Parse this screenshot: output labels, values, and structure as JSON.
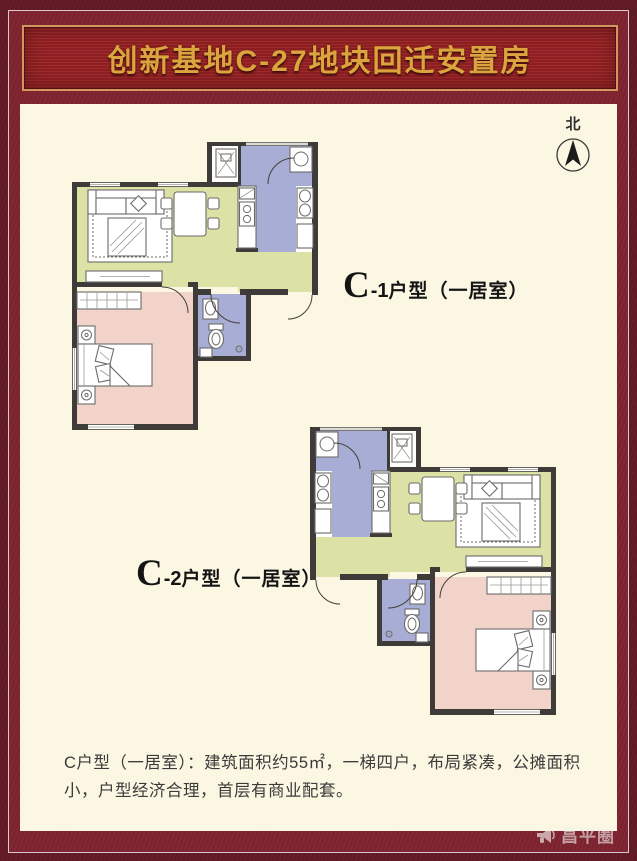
{
  "banner": {
    "title": "创新基地C-27地块回迁安置房"
  },
  "compass": {
    "label": "北"
  },
  "plans": [
    {
      "id": "C-1",
      "label_big": "C",
      "label_sub": "-1",
      "label_rest": "户型（一居室）"
    },
    {
      "id": "C-2",
      "label_big": "C",
      "label_sub": "-2",
      "label_rest": "户型（一居室）"
    }
  ],
  "description": {
    "text": "C户型（一居室）：建筑面积约55㎡，一梯四户，布局紧凑，公摊面积小，户型经济合理，首层有商业配套。"
  },
  "watermark": {
    "icon": "megaphone-icon",
    "text": "昌平圈"
  },
  "colors": {
    "maroon": "#7D2330",
    "banner_bg": "#8D1F24",
    "banner_stripe": "#9E2D29",
    "gold_text": "#DCA43E",
    "gold_border": "#D2975C",
    "cream": "#FBF7E2",
    "living": "#DCE1A6",
    "bedroom": "#F2D3C9",
    "wet": "#A7ADD4",
    "wall": "#3F3B38",
    "furniture": "#6B6B6B",
    "text": "#3B3B3B"
  }
}
